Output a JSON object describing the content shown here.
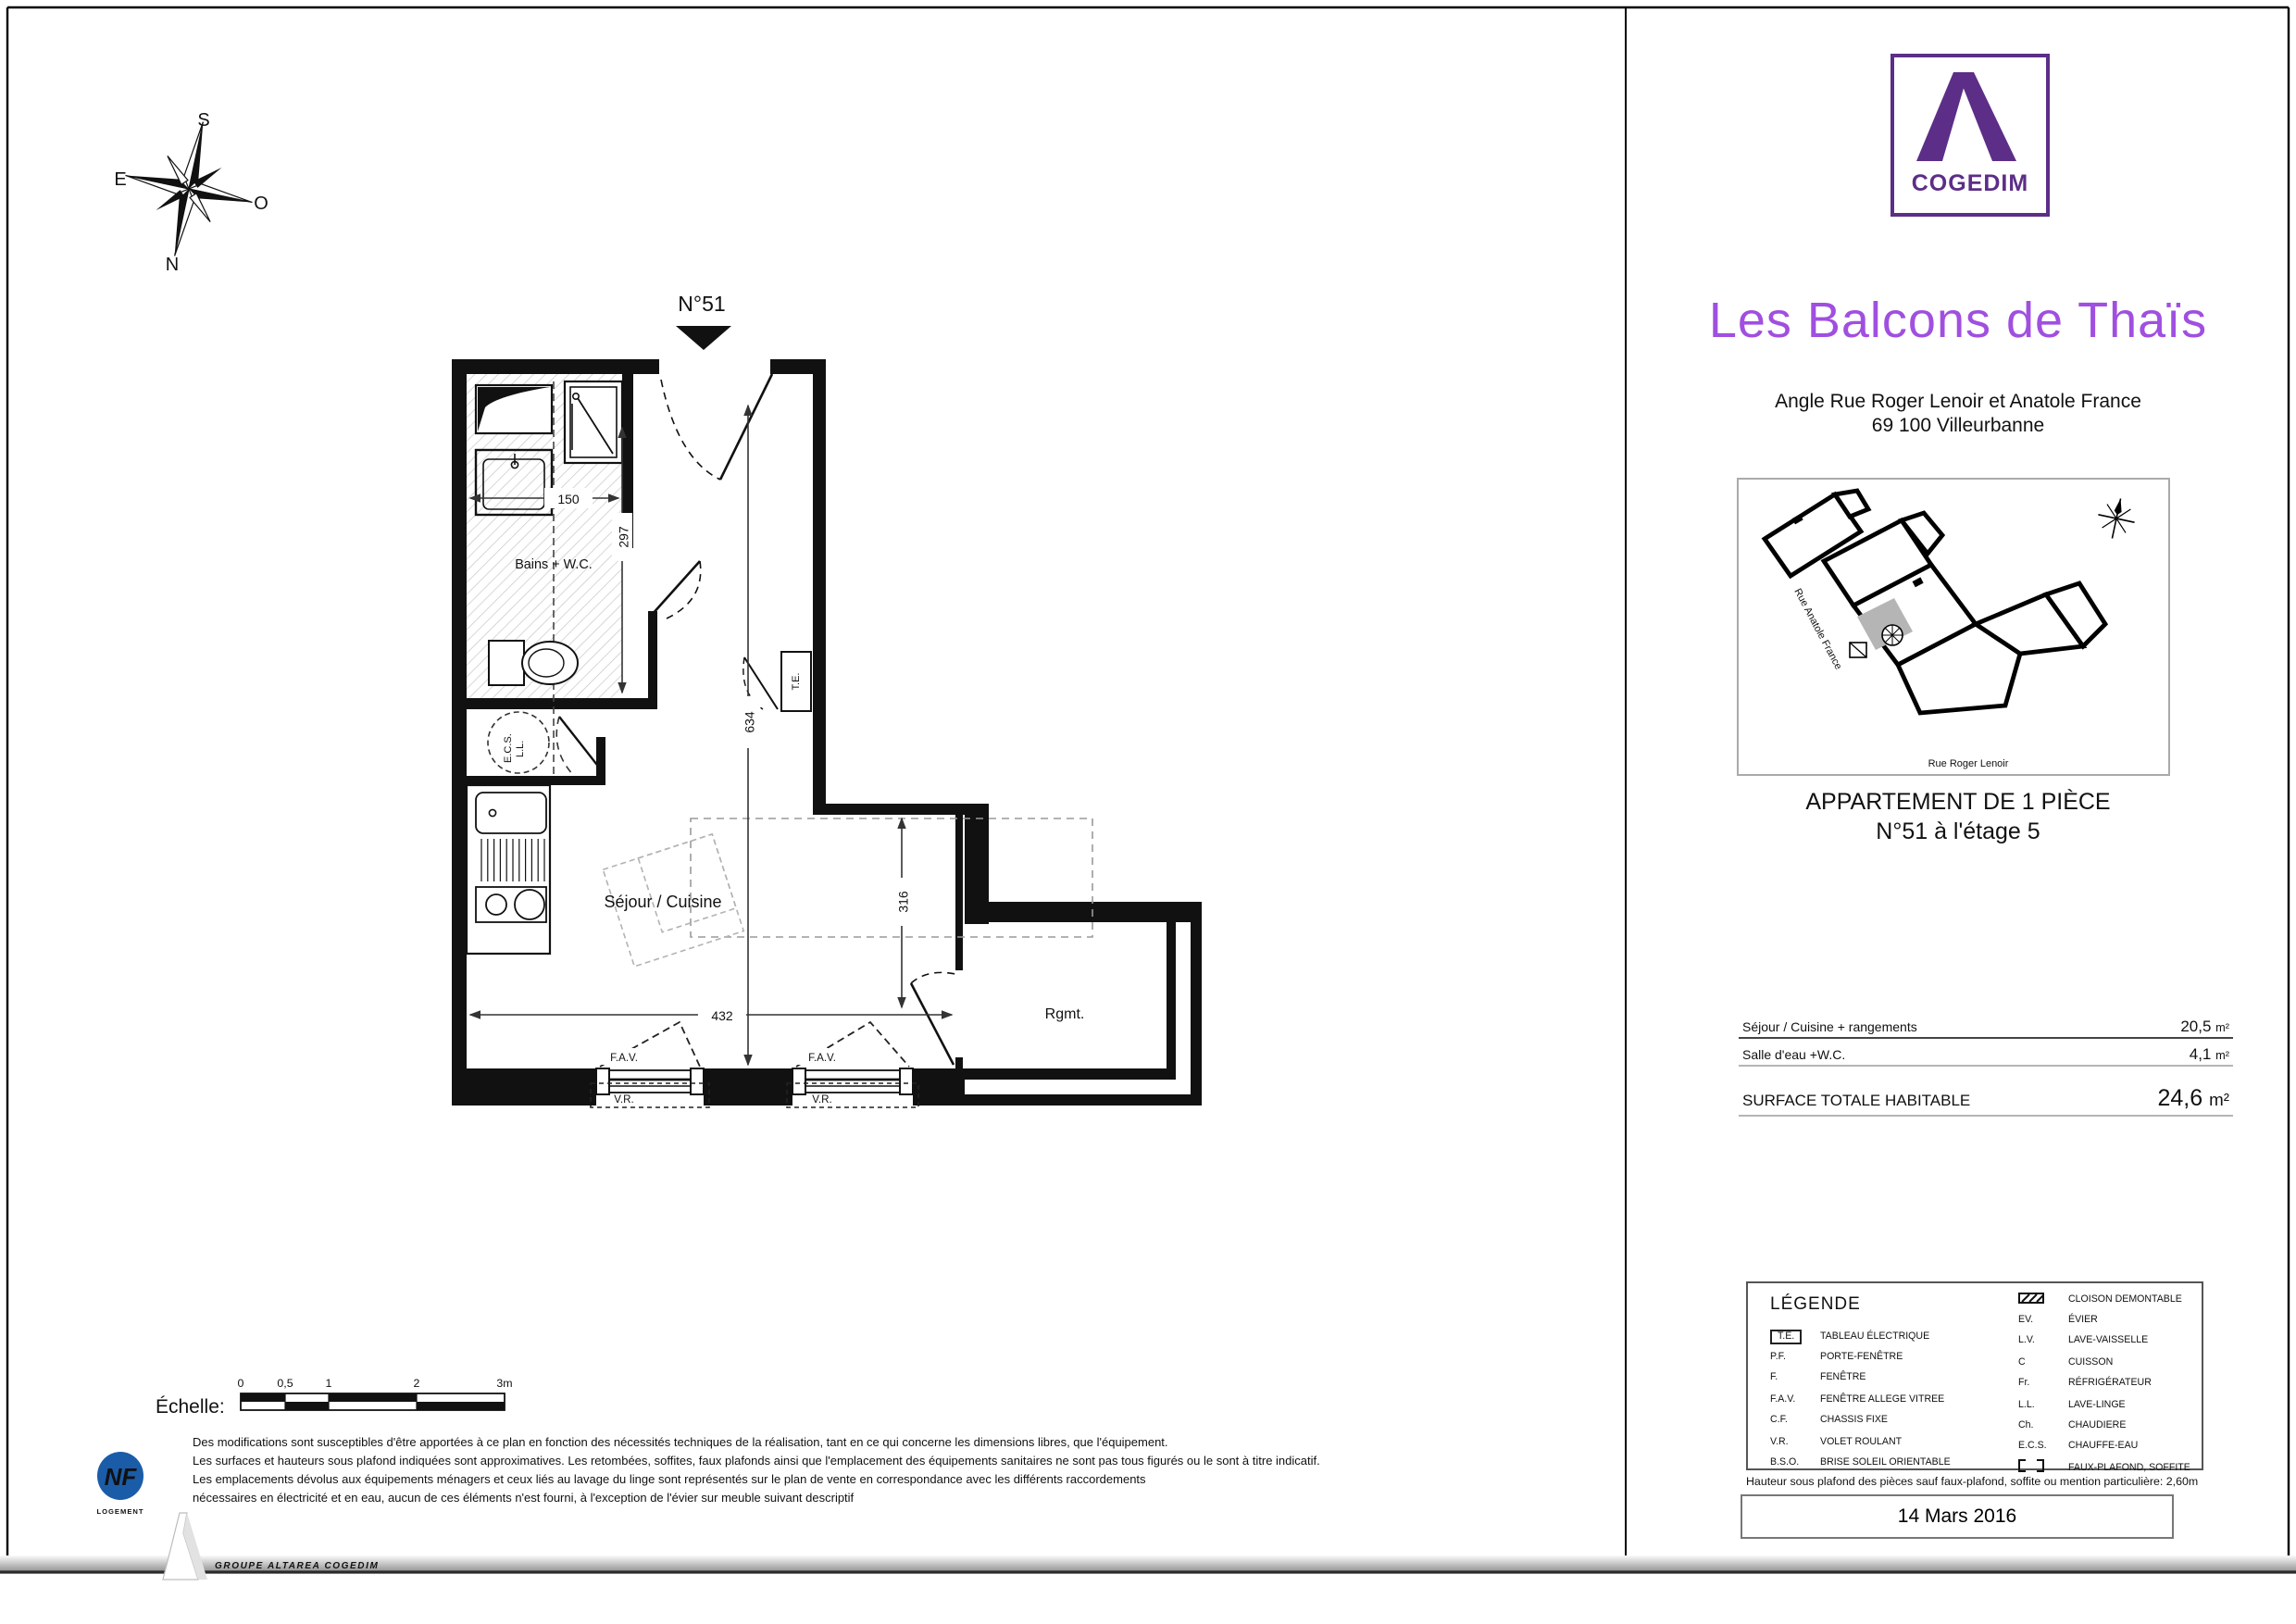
{
  "page": {
    "accent_purple": "#5C2E87",
    "title_purple": "#A04FE0",
    "nf_blue": "#1B5CA8",
    "footer_blue": "#2D5FA8"
  },
  "compass": {
    "s": "S",
    "e": "E",
    "o": "O",
    "n": "N"
  },
  "plan": {
    "unit_label": "N°51",
    "rooms": {
      "bains": "Bains + W.C.",
      "sejour": "Séjour / Cuisine",
      "rgmt": "Rgmt.",
      "ecs": "E.C.S.",
      "ll": "L.L."
    },
    "fixtures": {
      "te": "T.E."
    },
    "dims": {
      "bath_width": "150",
      "bath_height": "297",
      "entry_height": "634",
      "right_height": "316",
      "sejour_width": "432"
    },
    "windows": {
      "fav1": "F.A.V.",
      "fav2": "F.A.V.",
      "vr1": "V.R.",
      "vr2": "V.R."
    }
  },
  "scalebar": {
    "label": "Échelle:",
    "ticks": [
      "0",
      "0,5",
      "1",
      "2",
      "3m"
    ]
  },
  "brand": {
    "logo_text": "COGEDIM",
    "footer_text": "GROUPE ALTAREA COGEDIM",
    "nf_line1": "NF",
    "nf_line2": "LOGEMENT"
  },
  "header": {
    "title": "Les Balcons de Thaïs",
    "address_line1": "Angle Rue Roger Lenoir et Anatole France",
    "address_line2": "69 100 Villeurbanne"
  },
  "sitemap": {
    "street_left": "Rue Anatole France",
    "street_bottom": "Rue Roger Lenoir"
  },
  "apartment": {
    "line1": "APPARTEMENT DE 1 PIÈCE",
    "line2": "N°51 à l'étage 5"
  },
  "surfaces": {
    "rows": [
      {
        "label": "Séjour / Cuisine + rangements",
        "value": "20,5",
        "unit": "m²"
      },
      {
        "label": "Salle d'eau +W.C.",
        "value": "4,1",
        "unit": "m²"
      }
    ],
    "total": {
      "label": "SURFACE TOTALE HABITABLE",
      "value": "24,6",
      "unit": "m²"
    }
  },
  "legend": {
    "title": "LÉGENDE",
    "left": [
      {
        "abbr": "T.E.",
        "desc": "TABLEAU ÉLECTRIQUE"
      },
      {
        "abbr": "P.F.",
        "desc": "PORTE-FENÊTRE"
      },
      {
        "abbr": "F.",
        "desc": "FENÊTRE"
      },
      {
        "abbr": "F.A.V.",
        "desc": "FENÊTRE ALLEGE VITREE"
      },
      {
        "abbr": "C.F.",
        "desc": "CHASSIS FIXE"
      },
      {
        "abbr": "V.R.",
        "desc": "VOLET ROULANT"
      },
      {
        "abbr": "B.S.O.",
        "desc": "BRISE SOLEIL ORIENTABLE"
      }
    ],
    "right": [
      {
        "abbr": "",
        "desc": "CLOISON DEMONTABLE"
      },
      {
        "abbr": "EV.",
        "desc": "ÉVIER"
      },
      {
        "abbr": "L.V.",
        "desc": "LAVE-VAISSELLE"
      },
      {
        "abbr": "C",
        "desc": "CUISSON"
      },
      {
        "abbr": "Fr.",
        "desc": "RÉFRIGÉRATEUR"
      },
      {
        "abbr": "L.L.",
        "desc": "LAVE-LINGE"
      },
      {
        "abbr": "Ch.",
        "desc": "CHAUDIERE"
      },
      {
        "abbr": "E.C.S.",
        "desc": "CHAUFFE-EAU"
      },
      {
        "abbr": "",
        "desc": "FAUX-PLAFOND, SOFFITE"
      }
    ]
  },
  "notes": {
    "hauteur": "Hauteur sous plafond des pièces sauf faux-plafond, soffite ou mention particulière: 2,60m",
    "disclaimer": [
      "Des modifications sont susceptibles d'être apportées à ce plan en fonction des nécessités techniques de la réalisation, tant en ce qui concerne les dimensions libres, que l'équipement.",
      "Les surfaces et hauteurs sous plafond indiquées sont approximatives. Les retombées, soffites, faux plafonds ainsi que l'emplacement des équipements sanitaires ne sont pas tous figurés ou le sont à titre indicatif.",
      "Les emplacements dévolus aux équipements ménagers et ceux liés au lavage du linge sont représentés sur le plan de vente en correspondance avec les différents raccordements",
      "nécessaires en électricité et en eau, aucun de ces éléments n'est fourni, à l'exception de l'évier sur meuble suivant descriptif"
    ]
  },
  "date": "14 Mars 2016"
}
